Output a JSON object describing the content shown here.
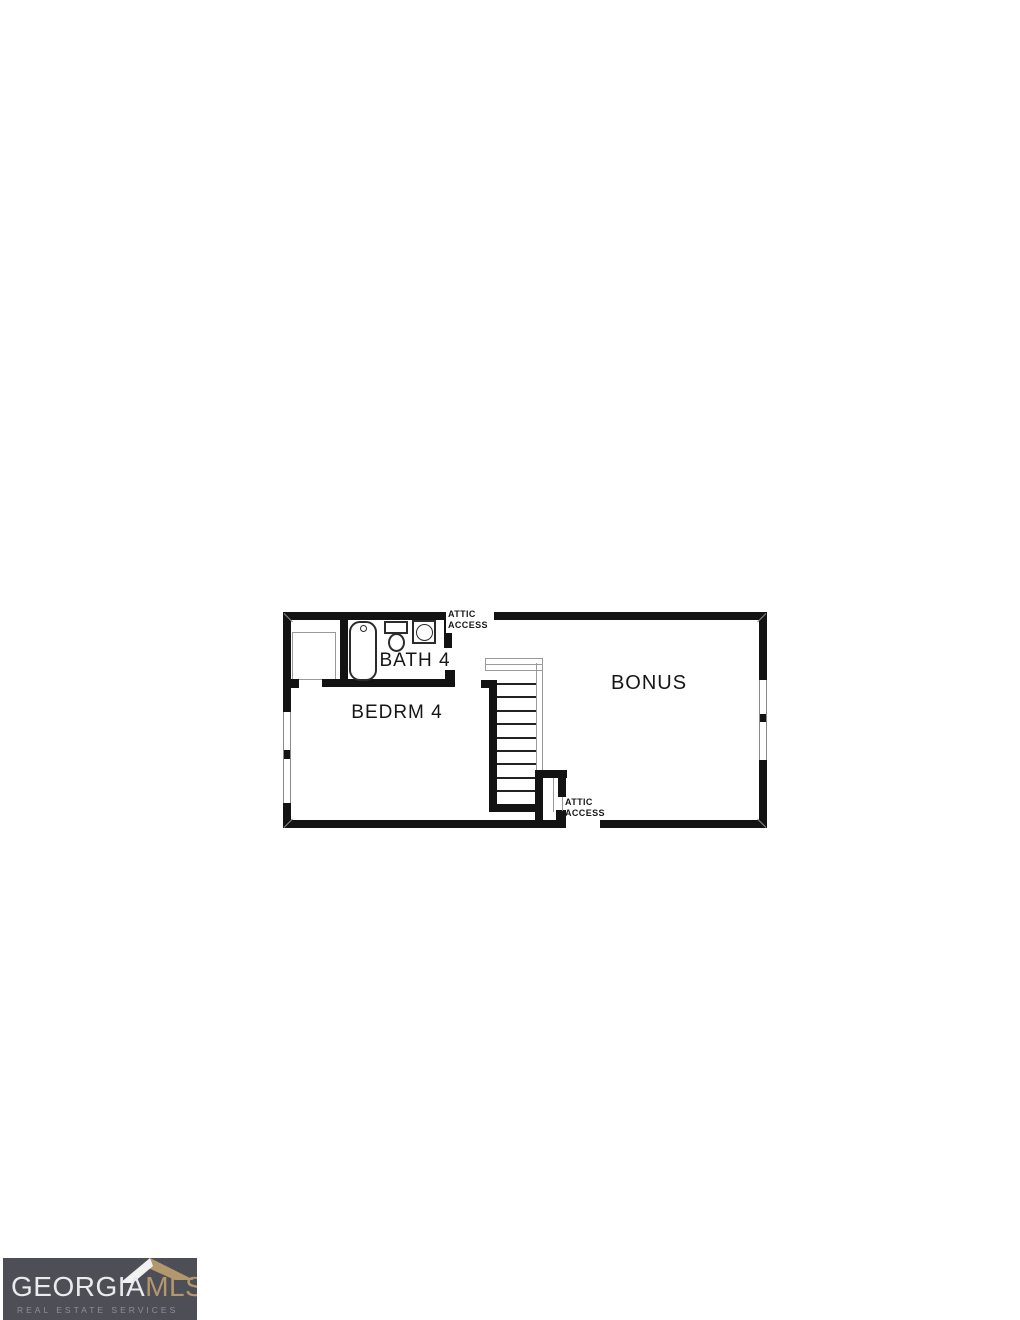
{
  "floor_plan": {
    "labels": {
      "bath": "BATH 4",
      "bedroom": "BEDRM 4",
      "bonus": "BONUS",
      "attic_top_line1": "ATTIC",
      "attic_top_line2": "ACCESS",
      "attic_bottom_line1": "ATTIC",
      "attic_bottom_line2": "ACCESS"
    },
    "stairs": {
      "tread_count": 9,
      "tread_spacing": 13.4
    },
    "colors": {
      "wall": "#131313",
      "thin_line": "#9a9a9a",
      "floor": "#ffffff"
    }
  },
  "logo": {
    "brand_primary": "GEORGIA",
    "brand_secondary": "MLS",
    "tagline": "REAL ESTATE SERVICES",
    "colors": {
      "background": "#4e4e57",
      "primary_text": "#ebebed",
      "secondary_text": "#b3986e",
      "tagline_text": "#8f8f99",
      "roof_left": "#f2f2f2",
      "roof_right": "#b3986e"
    }
  }
}
